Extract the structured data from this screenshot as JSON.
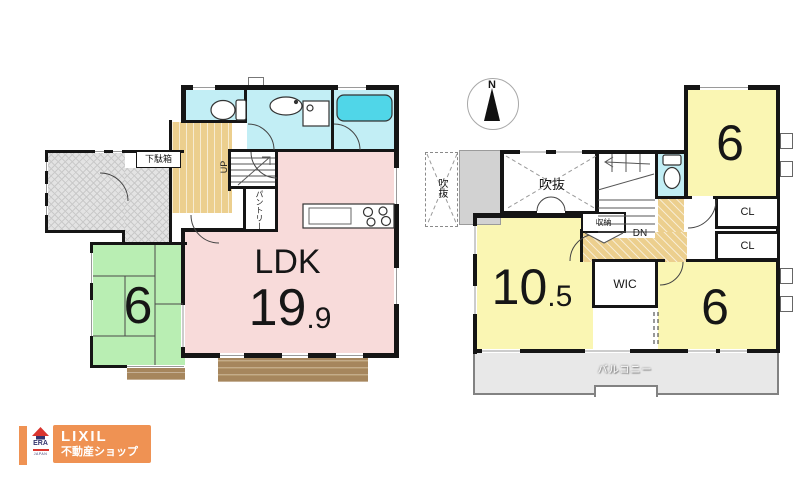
{
  "compass": {
    "north": "N"
  },
  "floor1": {
    "ldk": {
      "label": "LDK",
      "size_int": "19",
      "size_frac": ".9"
    },
    "tatami_room": {
      "size": "6"
    },
    "labels": {
      "shoe_cabinet": "下駄箱",
      "pantry": "パントリー",
      "stairs_up": "UP"
    }
  },
  "floor2": {
    "bedroom_main": {
      "size_int": "10",
      "size_frac": ".5"
    },
    "bedroom_ne": {
      "size": "6"
    },
    "bedroom_se": {
      "size": "6"
    },
    "labels": {
      "void_main": "吹抜",
      "void_west": "吹抜",
      "storage": "収納",
      "stairs_down": "DN",
      "wic": "WIC",
      "closet_a": "CL",
      "closet_b": "CL",
      "balcony": "バルコニー"
    }
  },
  "logo": {
    "era": "ERA",
    "era_country": "JAPAN",
    "brand": "LIXIL",
    "brand_service": "不動産ショップ"
  },
  "colors": {
    "wall": "#151515",
    "water_room_cyan": "#c2eef5",
    "bathtub_cyan": "#50d6e8",
    "ldk_pink": "#f8dbda",
    "tatami_green": "#b9eeb3",
    "room_yellow": "#faf6b3",
    "hall_tan": "#eccf8e",
    "deck_brown": "#a6865d",
    "porch_gray": "#e3e3e3",
    "balcony_gray": "#e8e8e8",
    "logo_orange": "#ef9253",
    "era_red": "#d9352f",
    "era_navy": "#34346d"
  }
}
